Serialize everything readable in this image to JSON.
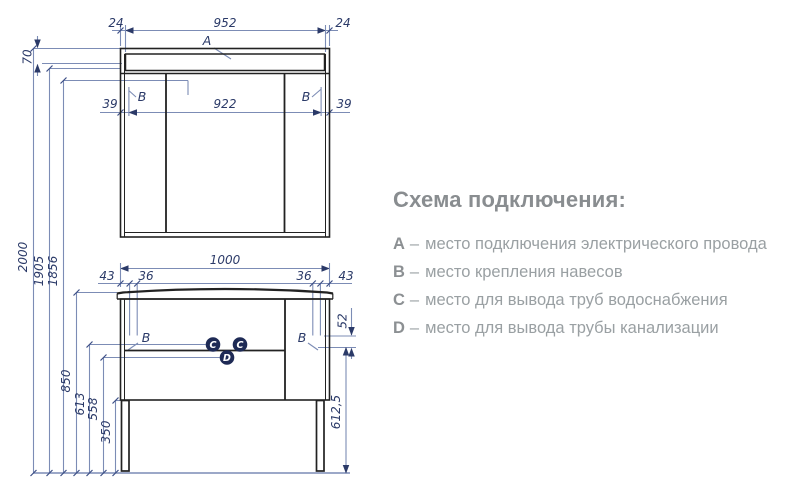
{
  "legend": {
    "title": "Схема подключения:",
    "separator": "–",
    "items": [
      {
        "key": "A",
        "desc": "место подключения электрического провода"
      },
      {
        "key": "B",
        "desc": "место крепления навесов"
      },
      {
        "key": "C",
        "desc": "место для вывода труб водоснабжения"
      },
      {
        "key": "D",
        "desc": "место для вывода трубы канализации"
      }
    ]
  },
  "dims": {
    "d24": "24",
    "d952": "952",
    "d70": "70",
    "d39": "39",
    "d922": "922",
    "d2000": "2000",
    "d1905": "1905",
    "d1856": "1856",
    "d850": "850",
    "d613": "613",
    "d558": "558",
    "d350": "350",
    "d1000": "1000",
    "d43": "43",
    "d36": "36",
    "d52": "52",
    "d6125": "612,5"
  },
  "markers": {
    "a": "A",
    "b": "B",
    "c": "C",
    "d": "D"
  },
  "colors": {
    "outline": "#222222",
    "dimension_line": "#7c8cb5",
    "dimension_text": "#2b3a68",
    "marker_fill": "#1e2a55",
    "legend_title": "#898d90",
    "legend_text": "#9aa0a3"
  }
}
